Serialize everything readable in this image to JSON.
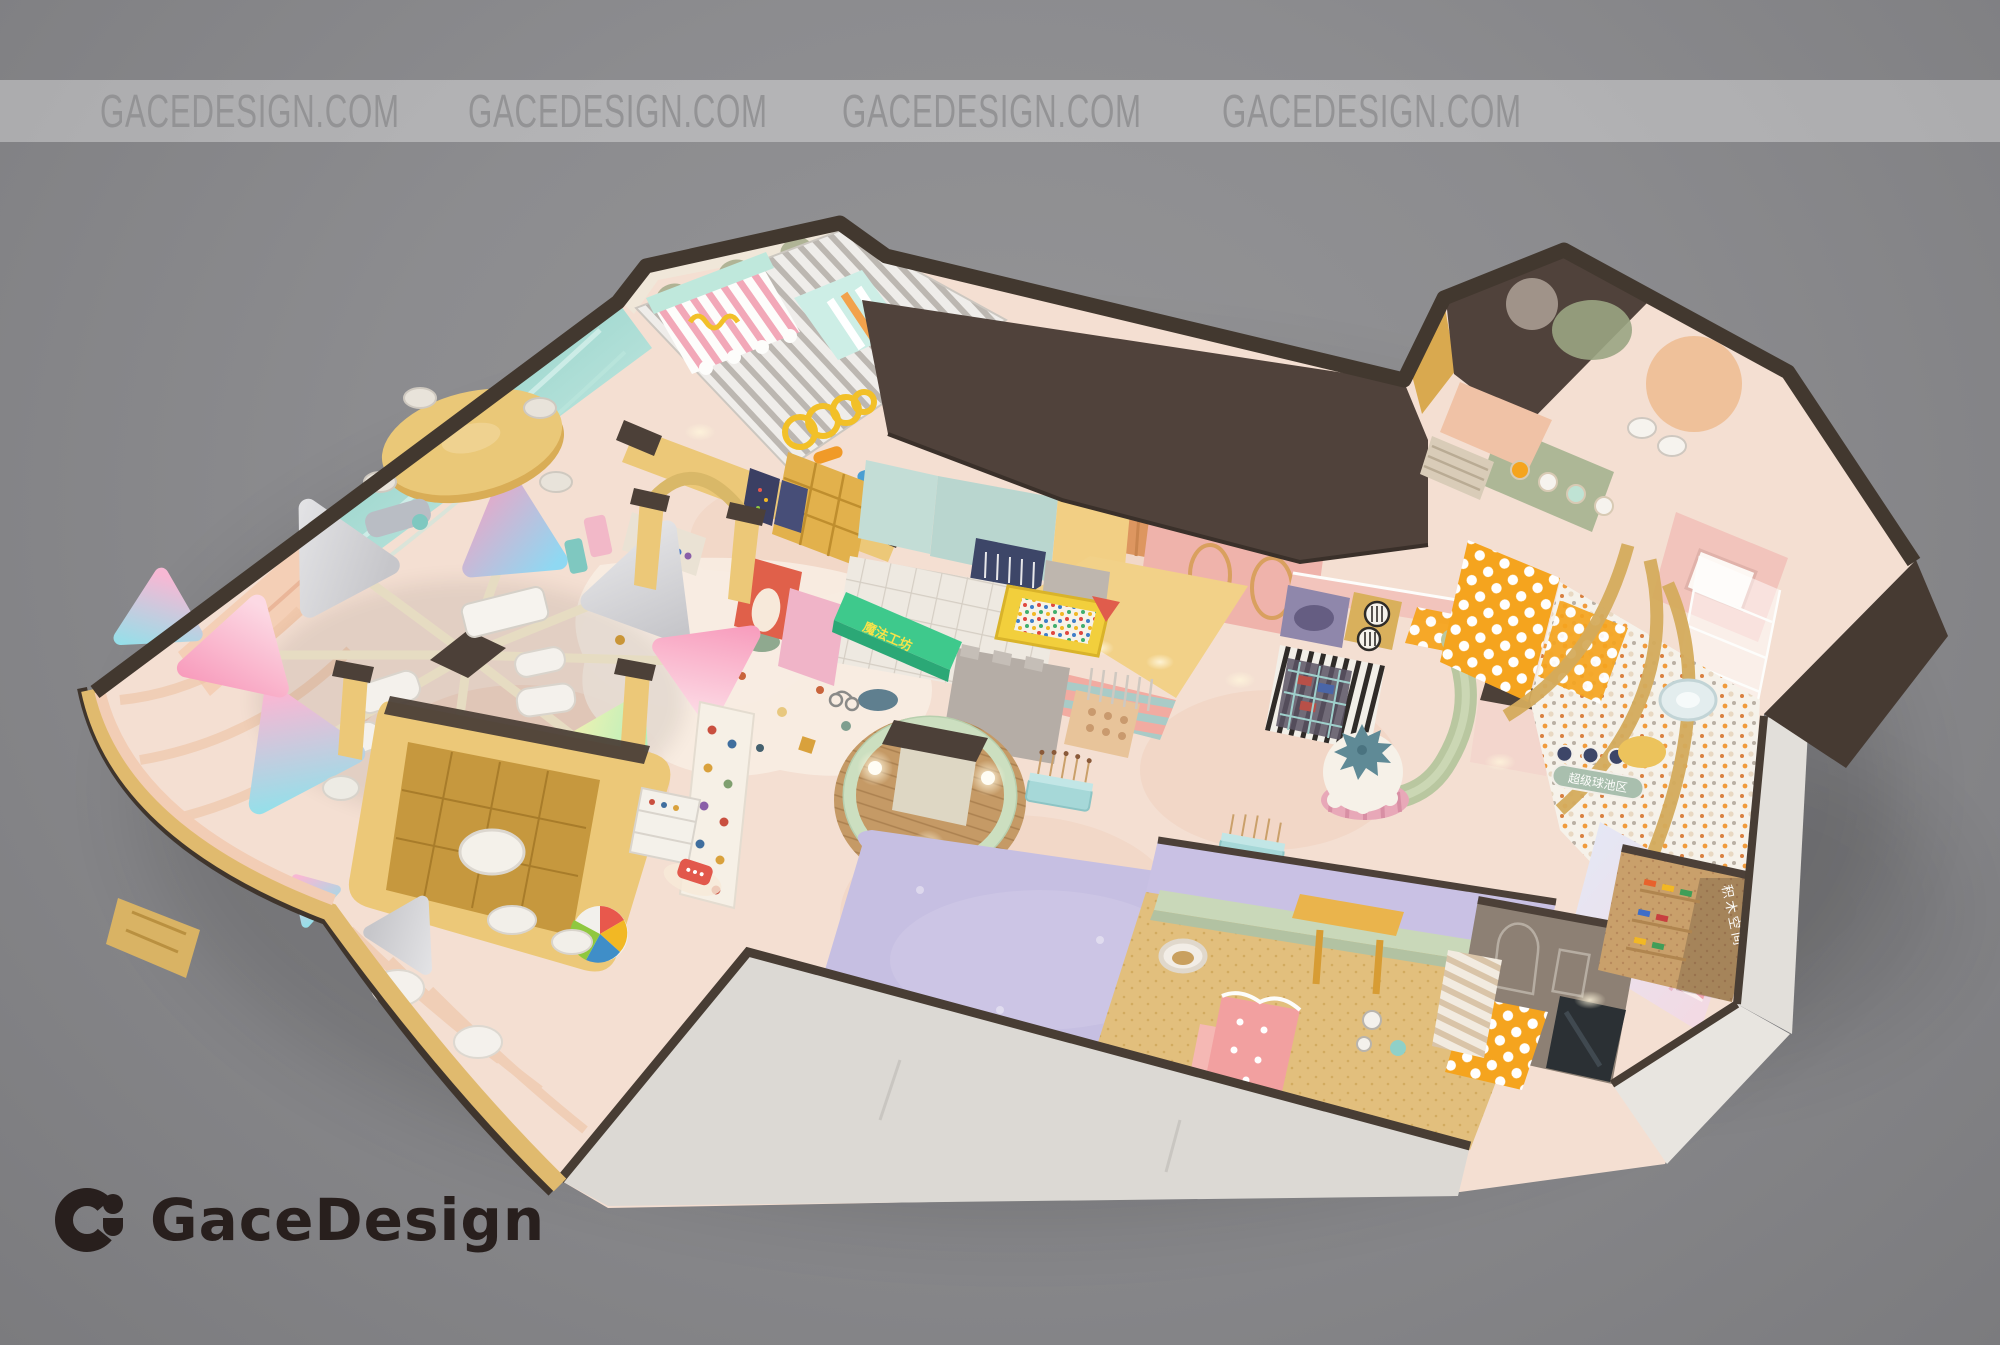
{
  "watermark": {
    "instances": [
      "GACEDESIGN.COM",
      "GACEDESIGN.COM",
      "GACEDESIGN.COM",
      "GACEDESIGN.COM"
    ]
  },
  "brand": {
    "name": "GaceDesign"
  },
  "scene": {
    "type": "isometric interior render",
    "subject": "children's indoor play center floor plan",
    "signs": {
      "workshop": "魔法工坊",
      "ball_pit": "超级球池区",
      "blocks_room": "积木空间"
    },
    "colors": {
      "background": "#8b8b8d",
      "banner_text": "#939395",
      "roof": "#50423b",
      "wall_dark": "#42382f",
      "floor": "#f4dfd2",
      "gold": "#ecc878",
      "lavender": "#c6bfe2",
      "mint": "#bfe3d4",
      "teal_wall": "#7fc9c0",
      "pink": "#f0b4c0",
      "orange": "#f5a41e",
      "logo_text": "#281f1d"
    },
    "areas": [
      "toddler-play-room",
      "candy-canopy",
      "toy-slide",
      "shelf-counter",
      "ferris-wheel-seating",
      "oval-dining-table",
      "teal-wave-wall",
      "arch-gates",
      "climbing-wall",
      "reception-desk",
      "beach-ball",
      "round-kiosk",
      "lavender-soft-mat",
      "candy-stick-stands",
      "terrazzo-floor",
      "castle-play-wall",
      "ball-pool-box",
      "boutique-shop",
      "play-kitchen",
      "giant-cupcake",
      "ball-pit",
      "tree-slide",
      "swirl-mat",
      "stair-mat",
      "nursery-room",
      "sand-room",
      "house-facade-theater",
      "building-blocks-room",
      "roof-slab",
      "outer-walls"
    ]
  }
}
